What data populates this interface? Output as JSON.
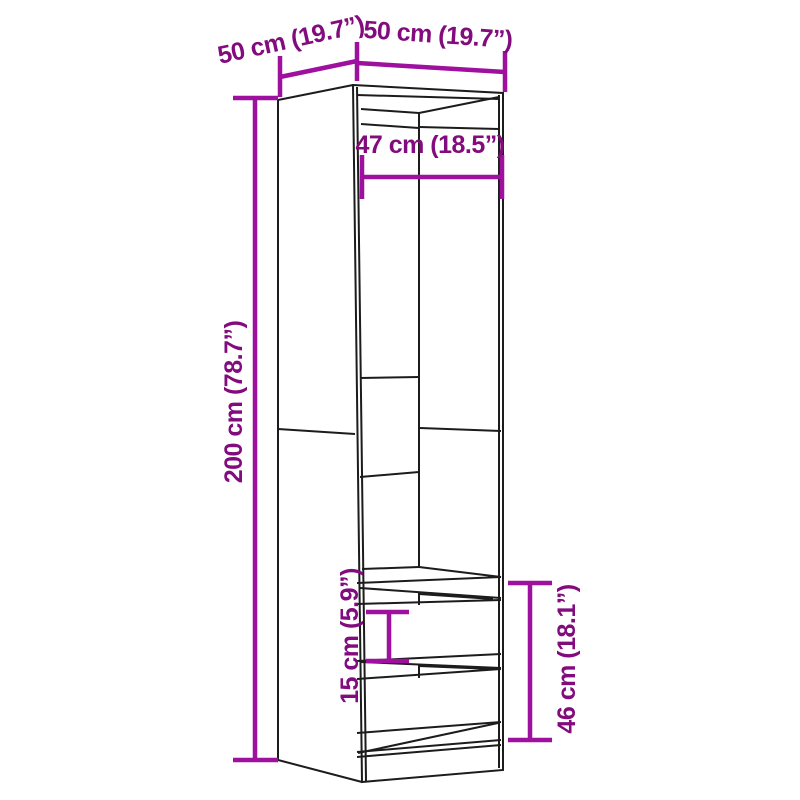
{
  "title": "Wardrobe with drawers - dimensions diagram",
  "colors": {
    "background": "#ffffff",
    "outline": "#1c1c1c",
    "dimension_line": "#9e109e",
    "dimension_text": "#820b7d"
  },
  "diagram": {
    "item": "wardrobe-with-two-drawers",
    "labels": {
      "depth_top": "50 cm (19.7”)",
      "width_top": "50 cm (19.7”)",
      "inner_width": "47 cm (18.5”)",
      "height": "200 cm (78.7”)",
      "drawer_height": "15 cm (5.9”)",
      "lower_section_height": "46 cm (18.1”)"
    }
  }
}
